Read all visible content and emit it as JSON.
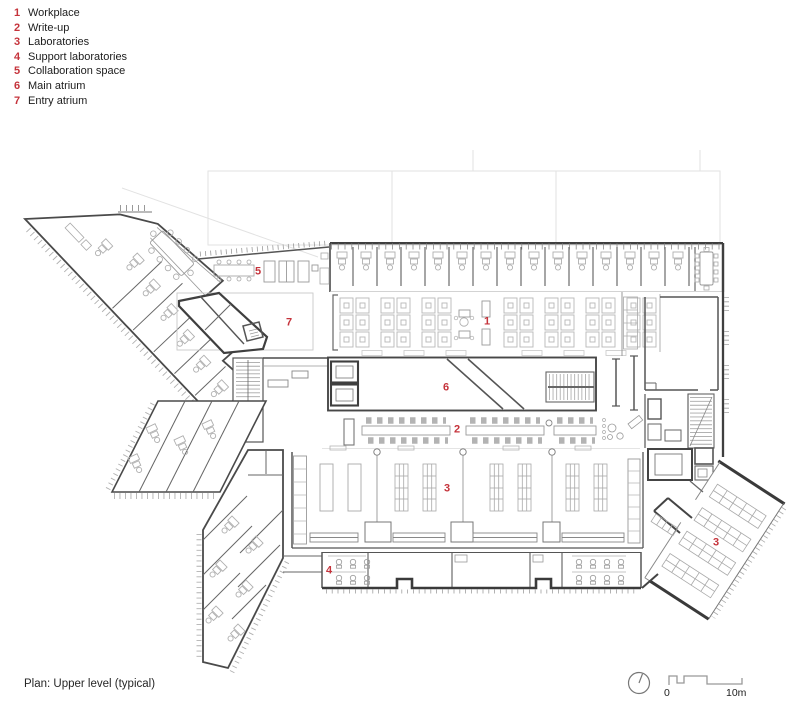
{
  "legend": {
    "items": [
      {
        "num": "1",
        "label": "Workplace"
      },
      {
        "num": "2",
        "label": "Write-up"
      },
      {
        "num": "3",
        "label": "Laboratories"
      },
      {
        "num": "4",
        "label": "Support laboratories"
      },
      {
        "num": "5",
        "label": "Collaboration space"
      },
      {
        "num": "6",
        "label": "Main atrium"
      },
      {
        "num": "7",
        "label": "Entry atrium"
      }
    ]
  },
  "caption": "Plan: Upper level (typical)",
  "scalebar": {
    "zero": "0",
    "ten": "10m"
  },
  "plan": {
    "accent_red": "#c5333b",
    "wall_color": "#3f3f3f",
    "furniture_color": "#b5b5b5",
    "labels": [
      {
        "text": "5",
        "x": 258,
        "y": 272
      },
      {
        "text": "7",
        "x": 289,
        "y": 323
      },
      {
        "text": "1",
        "x": 487,
        "y": 322
      },
      {
        "text": "6",
        "x": 446,
        "y": 388
      },
      {
        "text": "2",
        "x": 457,
        "y": 430
      },
      {
        "text": "3",
        "x": 447,
        "y": 489
      },
      {
        "text": "4",
        "x": 329,
        "y": 571
      },
      {
        "text": "3",
        "x": 716,
        "y": 543
      }
    ]
  }
}
